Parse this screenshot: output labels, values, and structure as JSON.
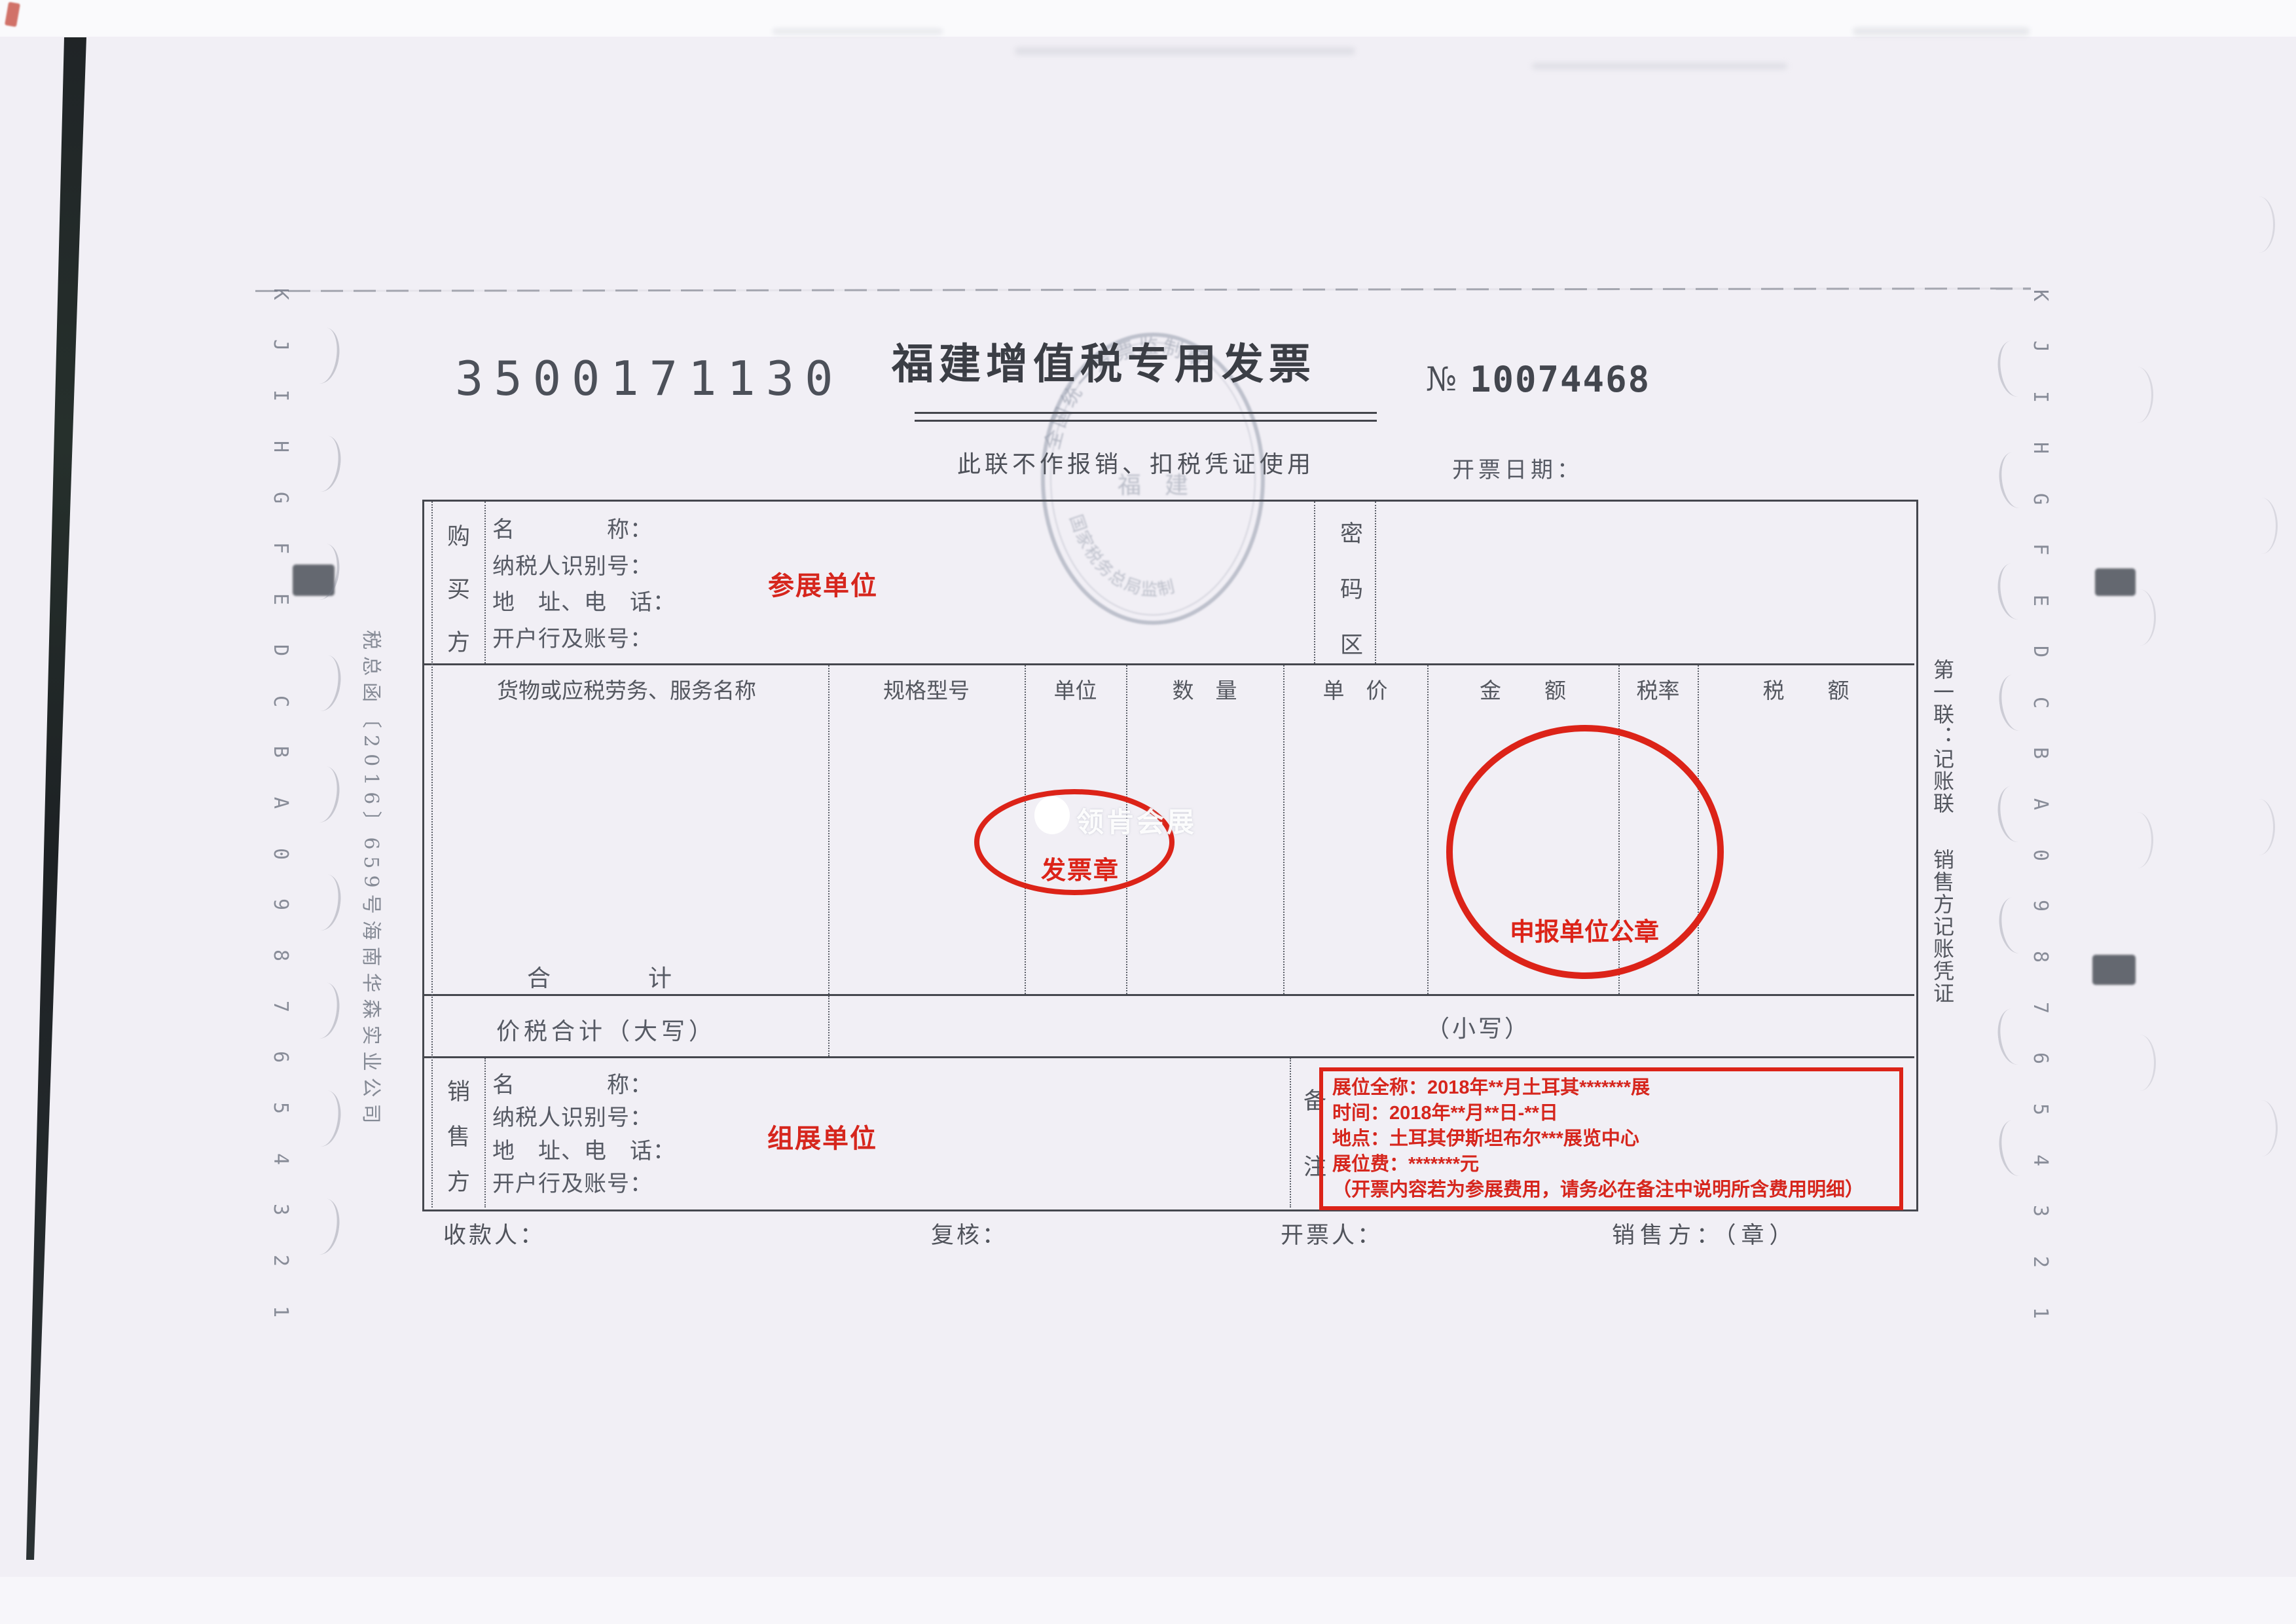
{
  "header": {
    "invoice_code": "3500171130",
    "title": "福建增值税专用发票",
    "subtitle": "此联不作报销、扣税凭证使用",
    "number_symbol": "№",
    "number": "10074468",
    "date_label": "开票日期：",
    "seal": {
      "top_text": "全国统一发票监制章",
      "center_text": "福　建",
      "bottom_text": "国家税务总局监制"
    }
  },
  "side_notes": {
    "left_note": "税总函〔2016〕659号海南华森实业公司",
    "copy_note_line1": "第一联：记账联",
    "copy_note_line2": "销售方记账凭证"
  },
  "buyer": {
    "side_label": "购买方",
    "fields": [
      "名　　　　称：",
      "纳税人识别号：",
      "地　址、电　话：",
      "开户行及账号："
    ],
    "annotation": "参展单位",
    "password_label": "密码区"
  },
  "items_table": {
    "headers": [
      "货物或应税劳务、服务名称",
      "规格型号",
      "单位",
      "数　量",
      "单　价",
      "金　　额",
      "税率",
      "税　　额"
    ],
    "total_label": "合　　　　计",
    "tax_total_label": "价税合计（大写）",
    "tax_total_small": "（小写）"
  },
  "stamps": {
    "invoice_stamp_label": "发票章",
    "declare_stamp_label": "申报单位公章"
  },
  "watermark": {
    "text": "领肯会展"
  },
  "seller": {
    "side_label": "销售方",
    "fields": [
      "名　　　　称：",
      "纳税人识别号：",
      "地　址、电　话：",
      "开户行及账号："
    ],
    "remark_label": "备注",
    "annotation": "组展单位",
    "remarks": [
      "展位全称：2018年**月土耳其*******展",
      "时间：2018年**月**日-**日",
      "地点：土耳其伊斯坦布尔***展览中心",
      "展位费：*******元",
      "（开票内容若为参展费用，请务必在备注中说明所含费用明细）"
    ]
  },
  "footer": {
    "payee_label": "收款人：",
    "review_label": "复核：",
    "drawer_label": "开票人：",
    "seller_seal_label": "销售方：（章）"
  },
  "edge_marks": {
    "sequence": [
      "K",
      "J",
      "I",
      "H",
      "G",
      "F",
      "E",
      "D",
      "C",
      "B",
      "A",
      "0",
      "9",
      "8",
      "7",
      "6",
      "5",
      "4",
      "3",
      "2",
      "1"
    ]
  },
  "colors": {
    "annotation_red": "#d6261d",
    "stamp_red": "#dc2318",
    "ink_gray": "#45474e",
    "paper": "#f1eff5"
  }
}
